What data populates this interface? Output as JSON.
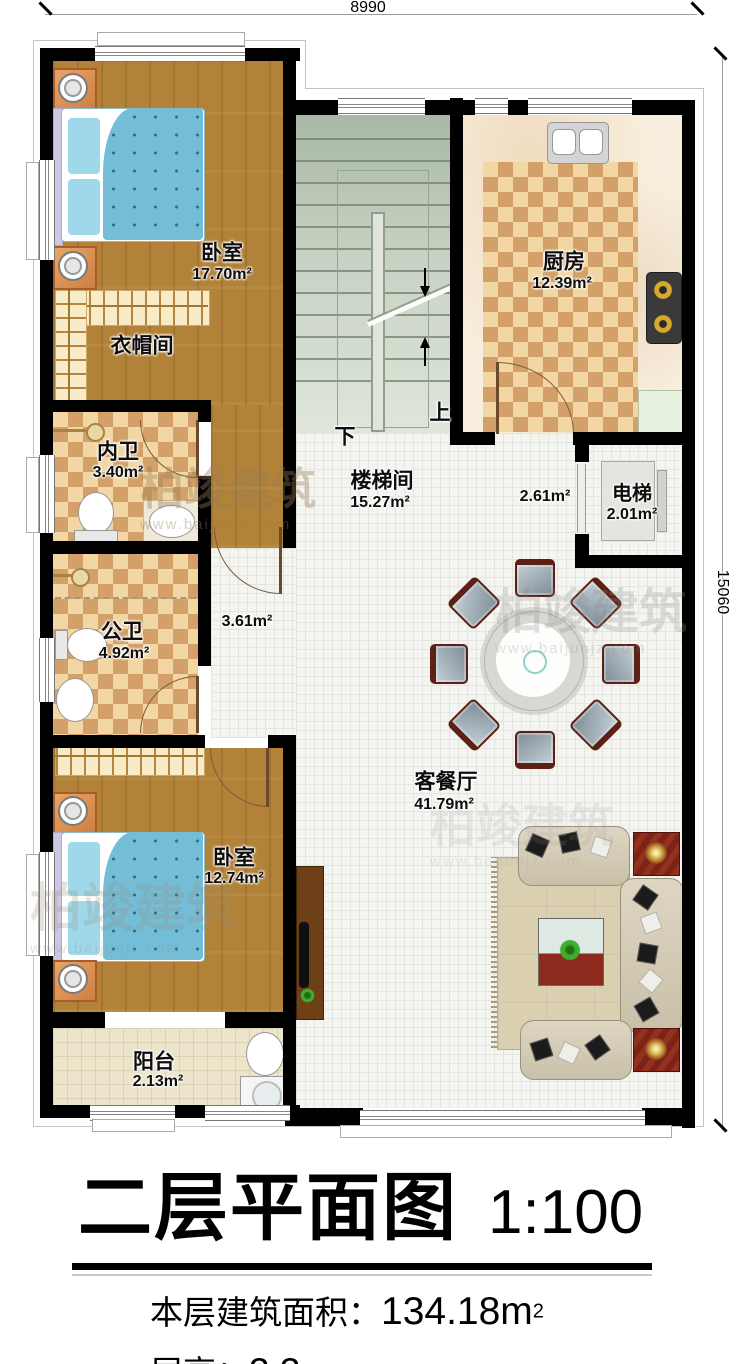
{
  "dim": {
    "top": "8990",
    "right": "15060"
  },
  "stairs": {
    "down": "下",
    "up": "上"
  },
  "rooms": {
    "bedroom1": {
      "name": "卧室",
      "area": "17.70m²"
    },
    "cloakroom": {
      "name": "衣帽间"
    },
    "bath_inner": {
      "name": "内卫",
      "area": "3.40m²"
    },
    "bath_public": {
      "name": "公卫",
      "area": "4.92m²"
    },
    "stairwell": {
      "name": "楼梯间",
      "area": "15.27m²"
    },
    "kitchen": {
      "name": "厨房",
      "area": "12.39m²"
    },
    "elevator": {
      "name": "电梯",
      "area": "2.01m²"
    },
    "living": {
      "name": "客餐厅",
      "area": "41.79m²"
    },
    "bedroom2": {
      "name": "卧室",
      "area": "12.74m²"
    },
    "balcony": {
      "name": "阳台",
      "area": "2.13m²"
    },
    "hall_right": {
      "area": "2.61m²"
    },
    "hall_left": {
      "area": "3.61m²"
    }
  },
  "title": {
    "text": "二层平面图",
    "scale": "1:100"
  },
  "info": {
    "area_label": "本层建筑面积：",
    "area_value": "134.18m",
    "area_sup": "2",
    "height_label": "层高：",
    "height_value": "3.3m"
  },
  "watermark": {
    "brand": "柏竣建筑",
    "url": "www.baijunjz.com"
  },
  "colors": {
    "wall": "#000000",
    "wood_floor": "#b28238",
    "checker_light": "#f2d7a4",
    "checker_dark": "#d2a068",
    "stair": "#c8d2c4",
    "tile": "#f4f4f1",
    "balcony_floor": "#ece4cb",
    "bed_quilt": "#74bdd6",
    "nightstand": "#cd7f43",
    "sofa": "#d5ccb5",
    "accent_red": "#7c2216"
  }
}
